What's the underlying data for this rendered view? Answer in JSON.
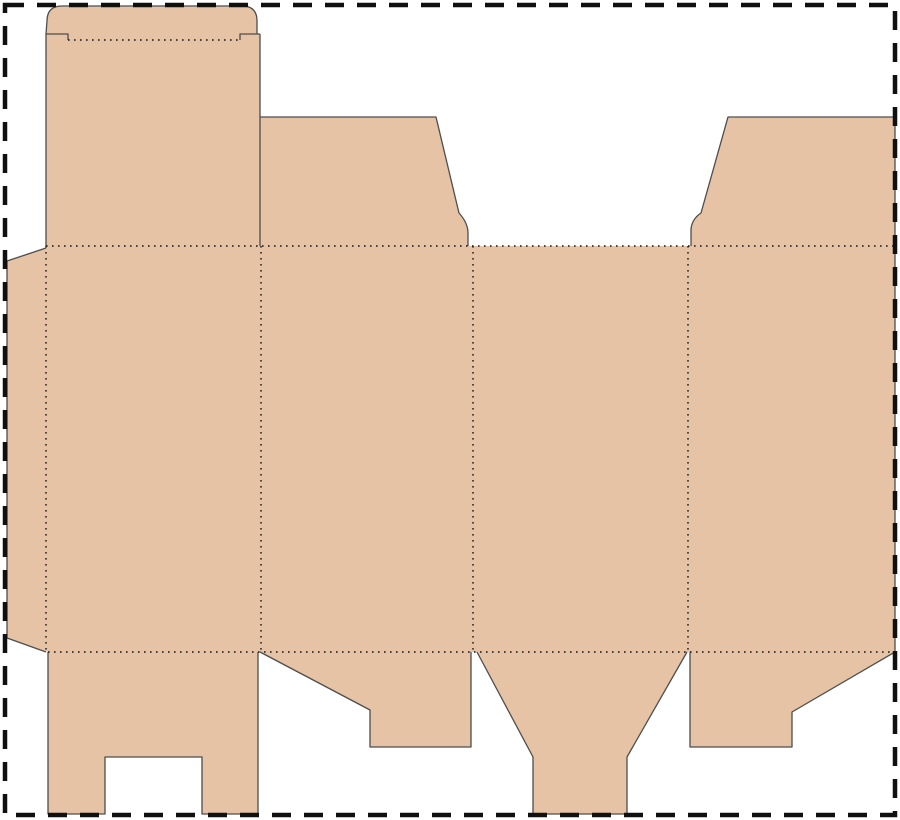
{
  "meta": {
    "title": "carton-box-dieline-template",
    "canvas": {
      "width": 900,
      "height": 820
    }
  },
  "colors": {
    "background": "#ffffff",
    "board_fill": "#e6c3a4",
    "cut_stroke": "#4d4d4d",
    "fold_stroke": "#161616",
    "border_stroke": "#101010"
  },
  "sheet_border": {
    "x": 5,
    "y": 5,
    "width": 890,
    "height": 810,
    "stroke_width": 4.5,
    "dash": "19 13"
  },
  "dieline": {
    "cut_stroke_width": 1.3,
    "fold_stroke_width": 1.4,
    "fold_dash": "1.6 4.4",
    "silhouette": "M 46,34 L 47,21 Q 47,6 62,6 L 242,6 Q 257,6 257,21 L 257,34 L 260,34 L 260,117 L 436,117 L 459,213 Q 468,223 468,233 L 468,246 L 691,246 L 691,229 Q 692,219 701,213 L 728,117 L 895,117 L 895,652 L 792,712 L 792,747 L 690,747 L 690,652 L 687,652 L 627,757 L 627,814 L 533,814 L 533,757 L 477,652 L 471,652 L 471,747 L 370,747 L 370,710 L 260,652 L 258,652 L 258,814 L 202,814 L 202,757 L 105,757 L 105,814 L 48,814 L 48,652 L 7,638 L 7,261 L 46,248 Z",
    "cut_lines": [
      {
        "name": "tuck-lid-outline",
        "d": "M 46,34 L 47,21 Q 47,6 62,6 L 242,6 Q 257,6 257,21 L 257,34"
      },
      {
        "name": "tuck-left-shoulder",
        "d": "M 46,34 L 68,34 L 68,40"
      },
      {
        "name": "tuck-right-shoulder",
        "d": "M 260,34 L 240,34 L 240,40"
      },
      {
        "name": "back-panel-left-edge",
        "d": "M 46,34 L 46,246"
      },
      {
        "name": "back-panel-right-slit",
        "d": "M 260,34 L 260,246"
      },
      {
        "name": "dust-flap-left-outline",
        "d": "M 260,117 L 436,117 L 459,213 Q 468,223 468,233 L 468,246"
      },
      {
        "name": "dust-flap-right-outline",
        "d": "M 691,246 L 691,229 Q 692,219 701,213 L 728,117 L 895,117 L 895,652"
      },
      {
        "name": "glue-flap-outline",
        "d": "M 46,248 L 7,261 L 7,638 L 46,652"
      },
      {
        "name": "bottom-flap-notched",
        "d": "M 258,652 L 258,814 L 202,814 L 202,757 L 105,757 L 105,814 L 48,814 L 48,652"
      },
      {
        "name": "bottom-flap-angled-left",
        "d": "M 260,652 L 370,710 L 370,747 L 471,747 L 471,652"
      },
      {
        "name": "bottom-flap-funnel",
        "d": "M 477,652 L 533,757 L 533,814 L 627,814 L 627,757 L 687,652"
      },
      {
        "name": "bottom-flap-angled-right",
        "d": "M 690,652 L 690,747 L 792,747 L 792,712 L 895,652"
      }
    ],
    "fold_lines": [
      {
        "name": "tuck-lid-crease",
        "d": "M 68,40 L 240,40"
      },
      {
        "name": "top-row-crease",
        "d": "M 46,246 L 895,246"
      },
      {
        "name": "bottom-row-crease",
        "d": "M 48,652 L 895,652"
      },
      {
        "name": "glue-flap-crease",
        "d": "M 46,246 L 46,652"
      },
      {
        "name": "panel-crease-1",
        "d": "M 261,246 L 261,652"
      },
      {
        "name": "panel-crease-2",
        "d": "M 473,246 L 473,652"
      },
      {
        "name": "panel-crease-3",
        "d": "M 688,246 L 688,652"
      }
    ]
  }
}
